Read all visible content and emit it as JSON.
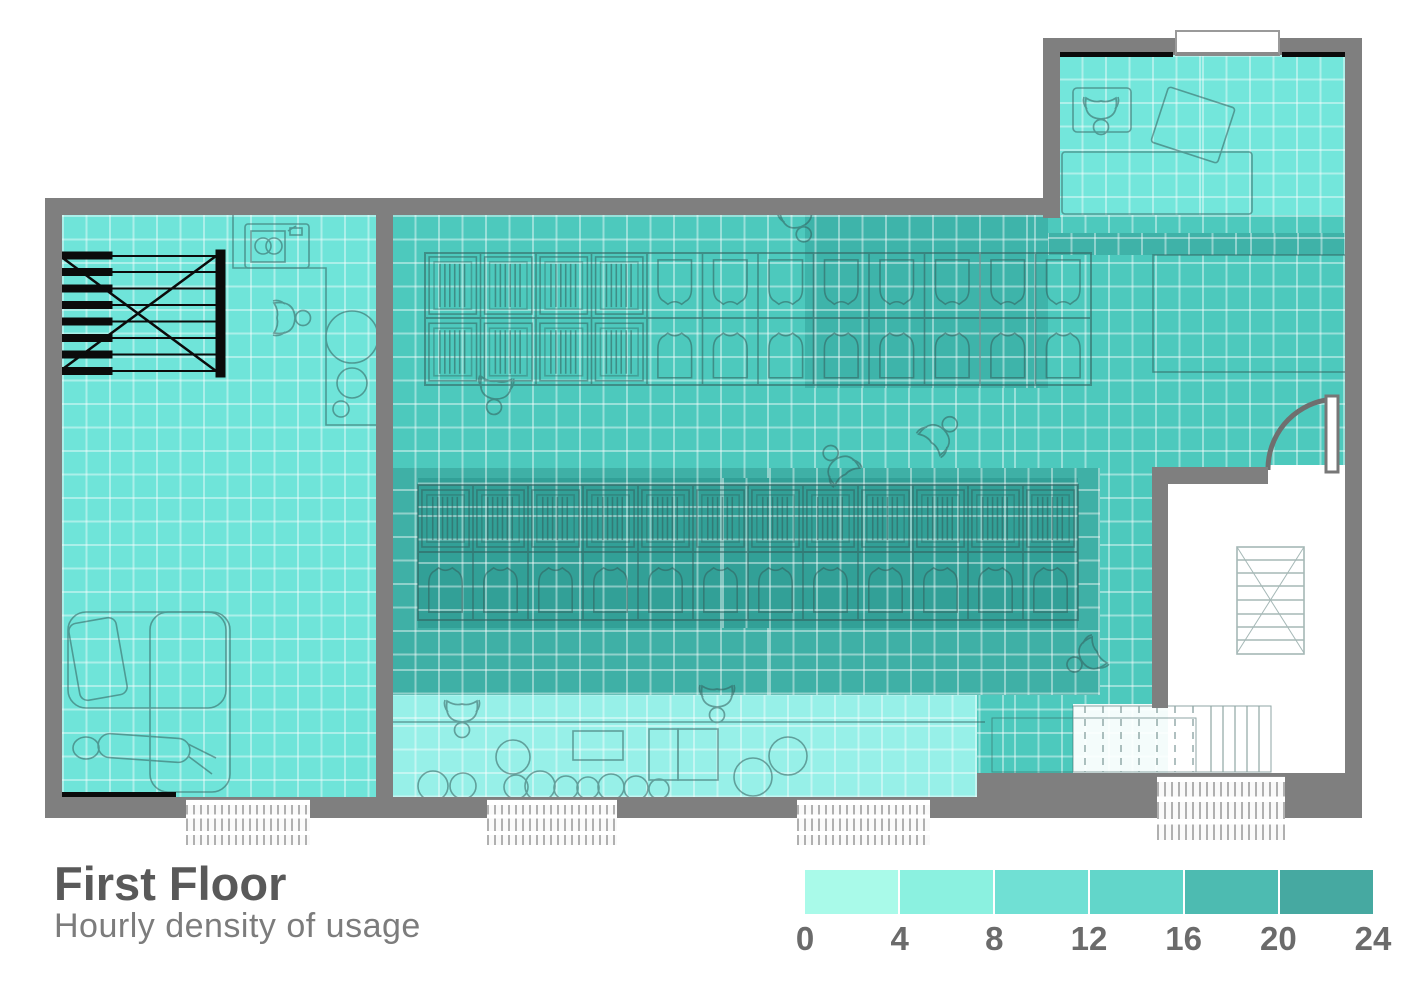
{
  "title": "First Floor",
  "subtitle": "Hourly density of usage",
  "chart_data": {
    "type": "heatmap",
    "title": "First Floor",
    "subtitle": "Hourly density of usage",
    "value_unit": "hours of usage per day",
    "scale": {
      "min": 0,
      "max": 24,
      "ticks": [
        "0",
        "4",
        "8",
        "12",
        "16",
        "20",
        "24"
      ],
      "bin_colors": [
        "#a9fae9",
        "#8bf1e0",
        "#70e0d4",
        "#62d6ca",
        "#4dbbb1",
        "#46a9a1"
      ],
      "legend_position": "bottom-right"
    },
    "zones": [
      {
        "id": "left-lounge",
        "label": "left lounge / print room",
        "density_hours": 8,
        "color": "#6fe4d9"
      },
      {
        "id": "upper-right-office",
        "label": "upper right office",
        "density_hours": 9,
        "color": "#73e6db"
      },
      {
        "id": "main-open-office",
        "label": "main open office",
        "density_hours": 13,
        "color": "#4dc9bd"
      },
      {
        "id": "upper-desk-cluster",
        "label": "upper desk cluster (right half)",
        "density_hours": 17,
        "color": "#3eb4aa"
      },
      {
        "id": "north-right-strip",
        "label": "strip below upper-right office",
        "density_hours": 17,
        "color": "#3fb2a8"
      },
      {
        "id": "central-desk-band",
        "label": "central desk band",
        "density_hours": 18,
        "color": "#3fb0a6"
      },
      {
        "id": "central-desk-core",
        "label": "central desk core",
        "density_hours": 21,
        "color": "#32a097"
      },
      {
        "id": "south-cafe-strip",
        "label": "south cafe strip",
        "density_hours": 6,
        "color": "#97f0e8"
      },
      {
        "id": "stairwell",
        "label": "stairwell (no data)",
        "density_hours": 0,
        "color": "#ffffff"
      }
    ]
  }
}
